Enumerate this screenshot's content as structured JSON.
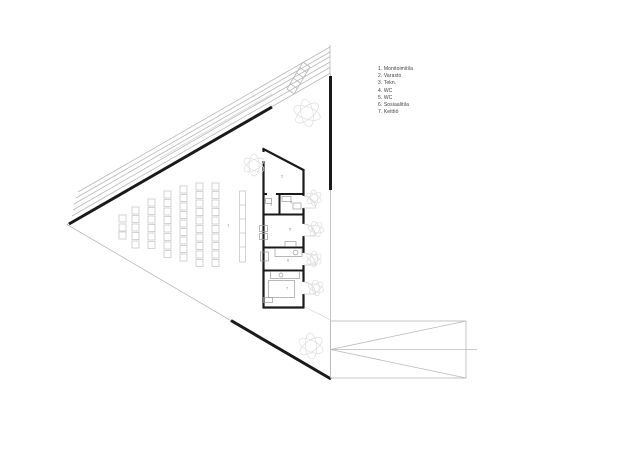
{
  "drawing": {
    "type": "architectural-floor-plan",
    "colors": {
      "background": "#ffffff",
      "wall": "#1a1a1a",
      "thin_line": "#b8b8b8",
      "furniture": "#c9c9c9",
      "tree": "#dedede",
      "legend_text": "#3f3f3f",
      "room_number_text": "#8a8a8a"
    }
  },
  "legend": {
    "items": [
      {
        "label": "1. Monitoimitila"
      },
      {
        "label": "2. Varasto"
      },
      {
        "label": "3. Tekn."
      },
      {
        "label": "4. WC"
      },
      {
        "label": "5. WC"
      },
      {
        "label": "6. Sosiaalitila"
      },
      {
        "label": "7. Keittiö"
      }
    ]
  },
  "plan": {
    "room_labels": [
      {
        "number": "1",
        "name": "Monitoimitila"
      },
      {
        "number": "2",
        "name": "Varasto"
      },
      {
        "number": "3",
        "name": "Tekn."
      },
      {
        "number": "4",
        "name": "WC"
      },
      {
        "number": "5",
        "name": "WC"
      },
      {
        "number": "6",
        "name": "Sosiaalitila"
      },
      {
        "number": "7",
        "name": "Keittiö"
      }
    ]
  }
}
